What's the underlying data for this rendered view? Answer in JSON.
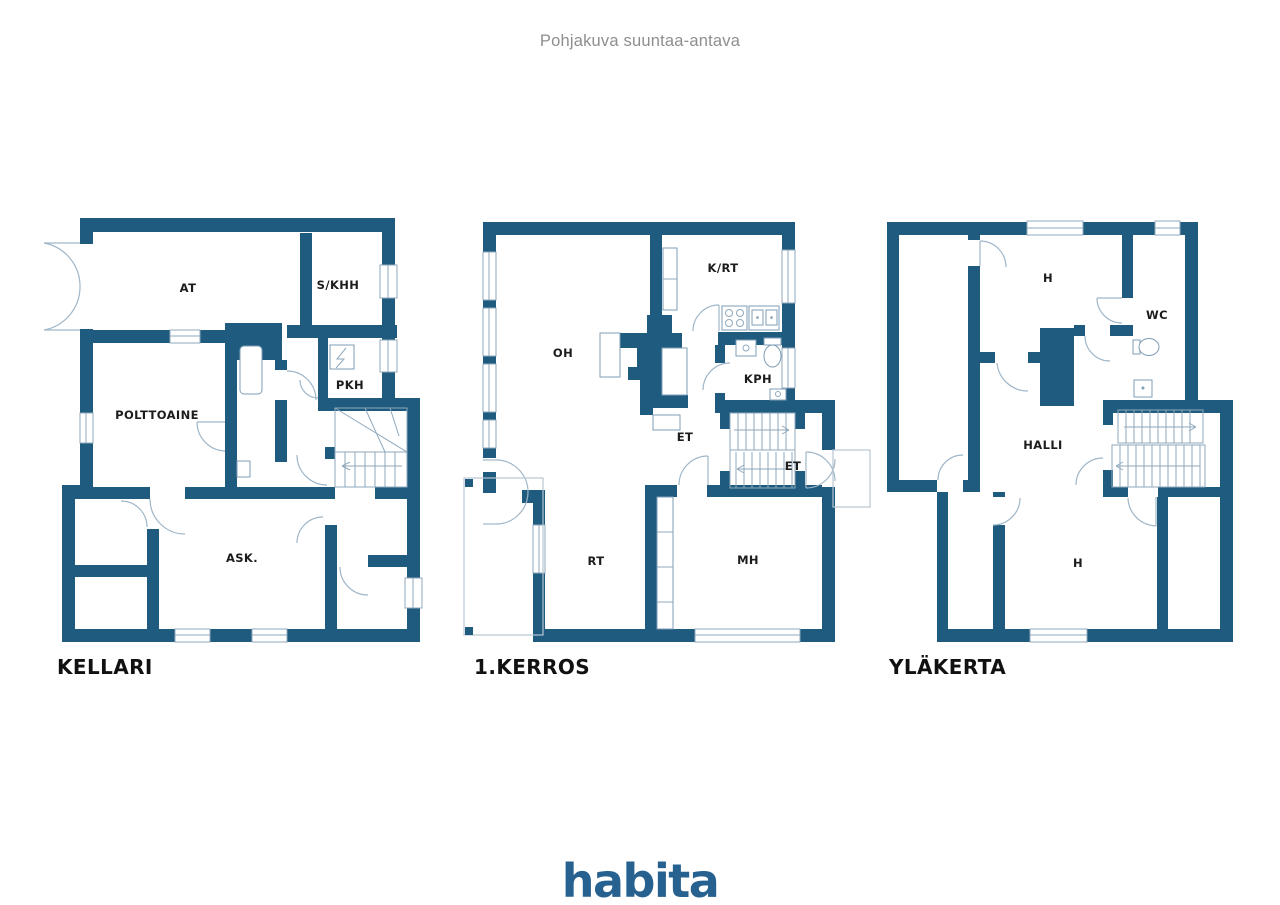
{
  "header": {
    "title": "Pohjakuva suuntaa-antava"
  },
  "footer": {
    "brand": "habita"
  },
  "colors": {
    "wall": "#1e5b7e",
    "logo": "#27618f",
    "thin_line": "#9fb6c8"
  },
  "plans": [
    {
      "title": "KELLARI",
      "rooms": [
        "AT",
        "S/KHH",
        "PKH",
        "POLTTOAINE",
        "ASK."
      ]
    },
    {
      "title": "1.KERROS",
      "rooms": [
        "OH",
        "K/RT",
        "KPH",
        "ET",
        "ET",
        "RT",
        "MH"
      ]
    },
    {
      "title": "YLÄKERTA",
      "rooms": [
        "H",
        "WC",
        "HALLI",
        "H"
      ]
    }
  ]
}
